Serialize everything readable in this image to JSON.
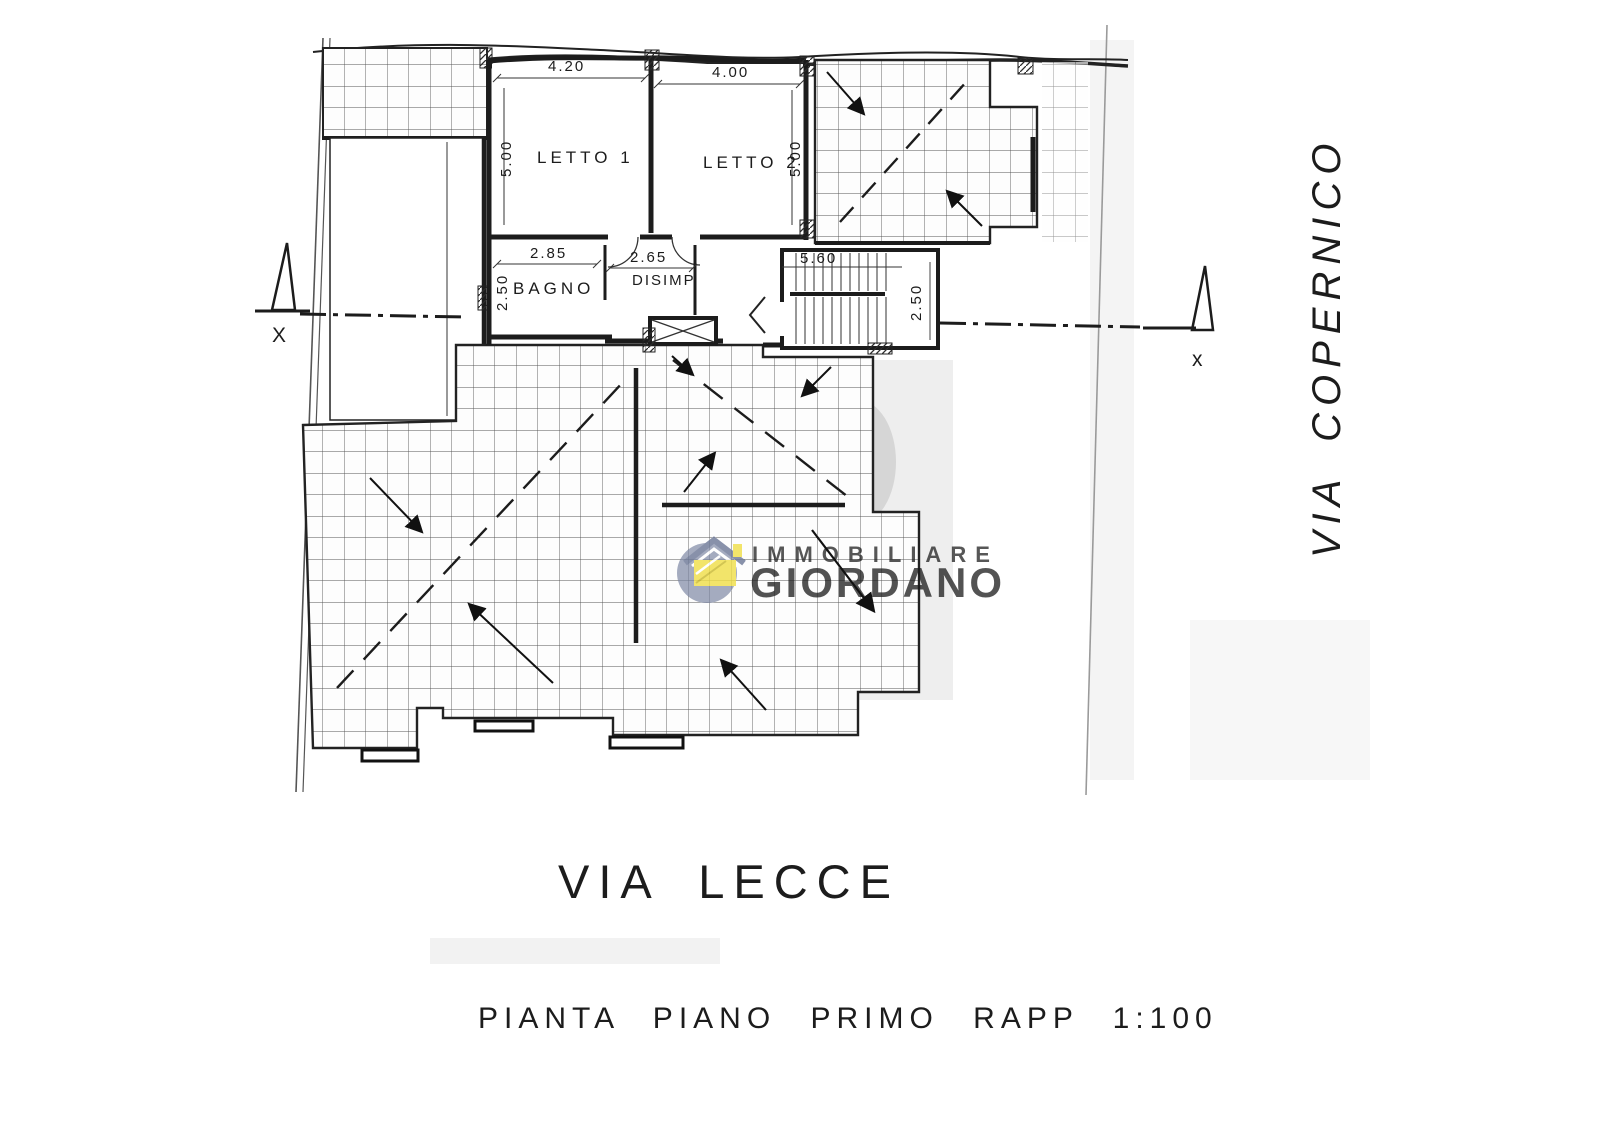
{
  "plan": {
    "rooms": {
      "letto1": "LETTO 1",
      "letto2": "LETTO 2",
      "bagno": "BAGNO",
      "disimp": "DISIMP"
    },
    "dimensions": {
      "letto1_width": "4.20",
      "letto2_width": "4.00",
      "letto1_depth": "5.00",
      "letto2_depth": "5.00",
      "bagno_width": "2.85",
      "disimp_width": "2.65",
      "bagno_depth": "2.50",
      "stairs_width": "5.60",
      "stairs_depth": "2.50"
    },
    "section_markers": {
      "left": "X",
      "right": "x"
    },
    "streets": {
      "bottom": "VIA LECCE",
      "right": "VIA COPERNICO"
    },
    "caption": "PIANTA PIANO PRIMO RAPP 1:100"
  },
  "watermark": {
    "agency_line1": "IMMOBILIARE",
    "agency_line2": "GIORDANO",
    "colors": {
      "badge": "#7d87a5",
      "house": "#f0df4a",
      "text": "#98a0b5"
    }
  }
}
